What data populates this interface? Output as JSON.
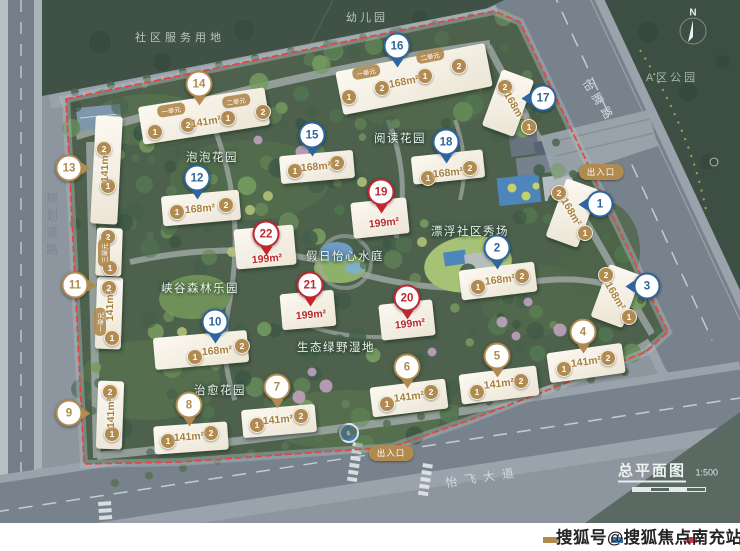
{
  "surroundings": {
    "community_service_land": "社区服务用地",
    "kindergarten": "幼儿园",
    "district_park": "A区公园",
    "road_east": "怡腾路",
    "road_west": "规划道路",
    "road_south": "怡飞大道"
  },
  "entrance_label": "出入口",
  "north_label": "N",
  "title_block": {
    "title": "总平面图",
    "scale": "1:500"
  },
  "watermark": "搜狐号@搜狐焦点南充站",
  "gardens": [
    "泡泡花园",
    "阅读花园",
    "假日怡心水庭",
    "漂浮社区秀场",
    "峡谷森林乐园",
    "生态绿野湿地",
    "治愈花园"
  ],
  "legend_colors": [
    "#b18a4f",
    "#2d659c",
    "#c1272d"
  ],
  "marker_colors": {
    "tan": "#b18a4f",
    "blue": "#2d659c",
    "red": "#c1272d"
  },
  "area_text_colors": {
    "standard": "#a8813f",
    "premium": "#c1272d"
  },
  "buildings": [
    {
      "no": "1",
      "color": "blue",
      "area": "168m²",
      "units": [
        "2",
        "1"
      ],
      "pills": []
    },
    {
      "no": "2",
      "color": "blue",
      "area": "168m²",
      "units": [
        "1",
        "2"
      ],
      "pills": []
    },
    {
      "no": "3",
      "color": "blue",
      "area": "168m²",
      "units": [
        "2",
        "1"
      ],
      "pills": []
    },
    {
      "no": "4",
      "color": "tan",
      "area": "141m²",
      "units": [
        "1",
        "2"
      ],
      "pills": []
    },
    {
      "no": "5",
      "color": "tan",
      "area": "141m²",
      "units": [
        "1",
        "2"
      ],
      "pills": []
    },
    {
      "no": "6",
      "color": "tan",
      "area": "141m²",
      "units": [
        "1",
        "2"
      ],
      "pills": []
    },
    {
      "no": "7",
      "color": "tan",
      "area": "141m²",
      "units": [
        "1",
        "2"
      ],
      "pills": []
    },
    {
      "no": "8",
      "color": "tan",
      "area": "141m²",
      "units": [
        "1",
        "2"
      ],
      "pills": []
    },
    {
      "no": "9",
      "color": "tan",
      "area": "141m²",
      "units": [
        "2",
        "1"
      ],
      "pills": []
    },
    {
      "no": "10",
      "color": "blue",
      "area": "168m²",
      "units": [
        "1",
        "2"
      ],
      "pills": []
    },
    {
      "no": "11",
      "color": "tan",
      "area": "141m²",
      "units": [
        "2",
        "1"
      ],
      "pills": [
        "一单元"
      ]
    },
    {
      "no": "12",
      "color": "blue",
      "area": "168m²",
      "units": [
        "1",
        "2"
      ],
      "pills": []
    },
    {
      "no": "13",
      "color": "tan",
      "area": "141m²",
      "units": [
        "2",
        "1",
        "2",
        "1"
      ],
      "pills": [
        "三单元"
      ]
    },
    {
      "no": "14",
      "color": "tan",
      "area": "141m²",
      "units": [
        "1",
        "2",
        "1",
        "2"
      ],
      "pills": [
        "一单元",
        "二单元"
      ]
    },
    {
      "no": "15",
      "color": "blue",
      "area": "168m²",
      "units": [
        "1",
        "2"
      ],
      "pills": []
    },
    {
      "no": "16",
      "color": "blue",
      "area": "168m²",
      "units": [
        "1",
        "2",
        "1",
        "2"
      ],
      "pills": [
        "一单元",
        "二单元"
      ]
    },
    {
      "no": "17",
      "color": "blue",
      "area": "168m²",
      "units": [
        "2",
        "1"
      ],
      "pills": []
    },
    {
      "no": "18",
      "color": "blue",
      "area": "168m²",
      "units": [
        "1",
        "2"
      ],
      "pills": []
    },
    {
      "no": "19",
      "color": "red",
      "area": "199m²",
      "units": [],
      "pills": []
    },
    {
      "no": "20",
      "color": "red",
      "area": "199m²",
      "units": [],
      "pills": []
    },
    {
      "no": "21",
      "color": "red",
      "area": "199m²",
      "units": [],
      "pills": []
    },
    {
      "no": "22",
      "color": "red",
      "area": "199m²",
      "units": [],
      "pills": []
    }
  ]
}
